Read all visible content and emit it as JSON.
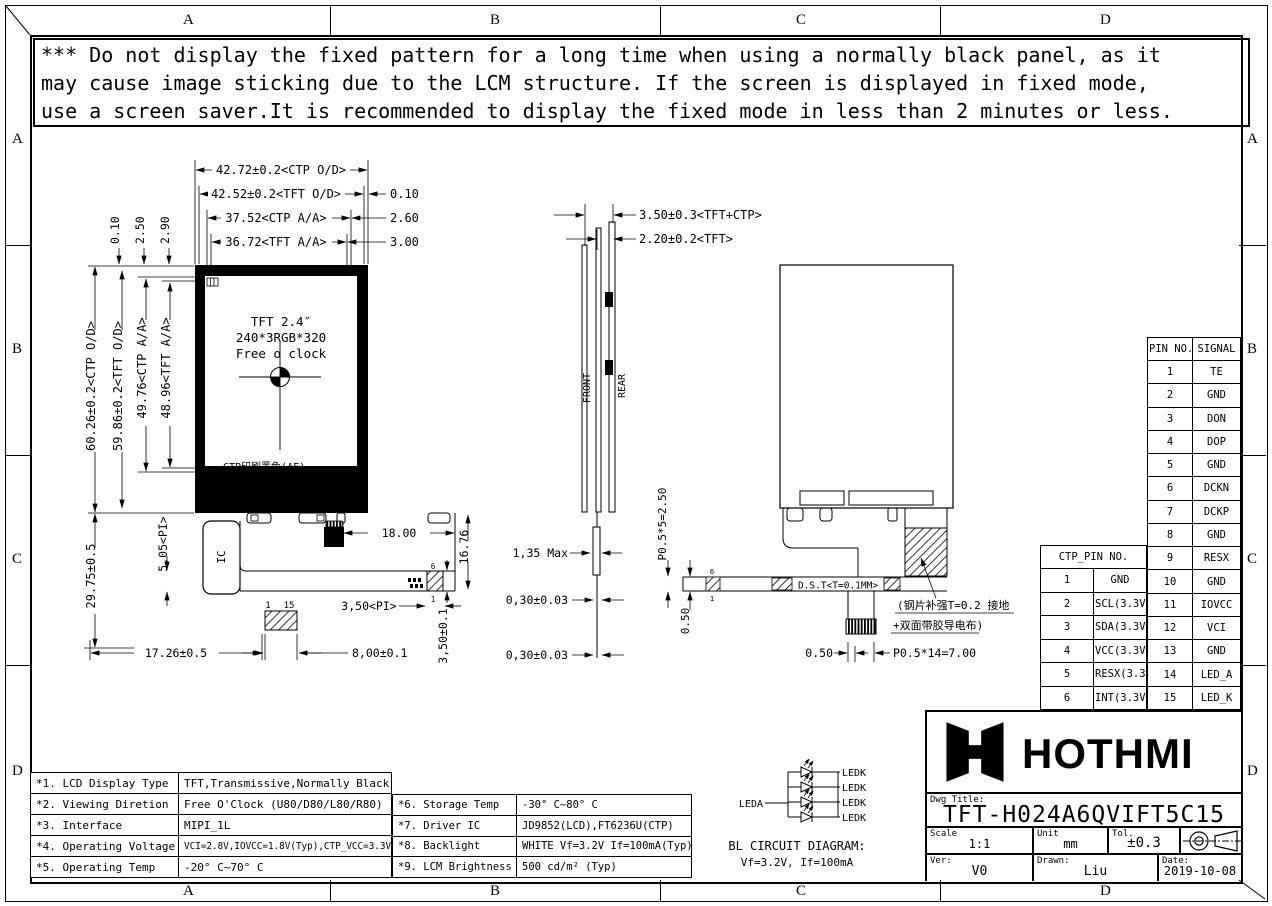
{
  "frame": {
    "zones": [
      "A",
      "B",
      "C",
      "D"
    ]
  },
  "warning": {
    "lines": [
      "*** Do not display the fixed pattern for a long time when using a normally black panel, as it",
      " may cause image sticking due to the LCM structure. If the screen is displayed in fixed mode,",
      " use a screen saver.It is recommended to display the fixed mode in less than 2 minutes or less."
    ]
  },
  "front_view": {
    "screen": {
      "line1": "TFT 2.4″",
      "line2": "240*3RGB*320",
      "line3": "Free o clock"
    },
    "ctp_print_note": "CTP印刷黑色(AF)",
    "ic_label": "IC",
    "pin_first": "1",
    "pin_last": "15",
    "tail_pin_top": "6",
    "tail_pin_bottom": "1",
    "dims": {
      "ctp_od_w": "42.72±0.2<CTP O/D>",
      "tft_od_w": "42.52±0.2<TFT O/D>",
      "offset_010": "0.10",
      "ctp_aa_w": "37.52<CTP A/A>",
      "offset_260": "2.60",
      "tft_aa_w": "36.72<TFT A/A>",
      "offset_300": "3.00",
      "top_010": "0.10",
      "top_250": "2.50",
      "top_290": "2.90",
      "ctp_od_h": "60.26±0.2<CTP O/D>",
      "tft_od_h": "59.86±0.2<TFT O/D>",
      "ctp_aa_h": "49.76<CTP A/A>",
      "tft_aa_h": "48.96<TFT A/A>",
      "left_2975": "29.75±0.5",
      "pi_505": "5,05<PI>",
      "bottom_1726": "17.26±0.5",
      "d1800": "18.00",
      "d1676": "16.76",
      "pi_350": "3,50<PI>",
      "d800": "8,00±0.1",
      "d350": "3,50±0.1"
    }
  },
  "side_view": {
    "front_label": "FRONT",
    "rear_label": "REAR",
    "tail_pin_top": "6",
    "tail_pin_bottom": "1",
    "dims": {
      "total": "3.50±0.3<TFT+CTP>",
      "tft": "2.20±0.2<TFT>",
      "max135": "1,35 Max",
      "d030a": "0,30±0.03",
      "d030b": "0,30±0.03",
      "pitch5": "P0.5*5=2.50",
      "d050": "0.50"
    }
  },
  "rear_view": {
    "dst_note": "D.S.T<T=0.1MM>",
    "stiffener_note_line1": "(钢片补强T=0.2 接地",
    "stiffener_note_line2": "+双面带胶导电布)",
    "dims": {
      "d050": "0.50",
      "pitch14": "P0.5*14=7.00"
    }
  },
  "signal_table": {
    "headers": [
      "PIN NO.",
      "SIGNAL"
    ],
    "rows": [
      [
        "1",
        "TE"
      ],
      [
        "2",
        "GND"
      ],
      [
        "3",
        "DON"
      ],
      [
        "4",
        "DOP"
      ],
      [
        "5",
        "GND"
      ],
      [
        "6",
        "DCKN"
      ],
      [
        "7",
        "DCKP"
      ],
      [
        "8",
        "GND"
      ],
      [
        "9",
        "RESX"
      ],
      [
        "10",
        "GND"
      ],
      [
        "11",
        "IOVCC"
      ],
      [
        "12",
        "VCI"
      ],
      [
        "13",
        "GND"
      ],
      [
        "14",
        "LED_A"
      ],
      [
        "15",
        "LED_K"
      ]
    ]
  },
  "ctp_table": {
    "header": "CTP_PIN NO.",
    "rows": [
      [
        "1",
        "GND"
      ],
      [
        "2",
        "SCL(3.3V)"
      ],
      [
        "3",
        "SDA(3.3V)"
      ],
      [
        "4",
        "VCC(3.3V)"
      ],
      [
        "5",
        "RESX(3.3V)"
      ],
      [
        "6",
        "INT(3.3V)"
      ]
    ]
  },
  "spec_table_left": {
    "rows": [
      [
        "*1. LCD Display Type",
        "TFT,Transmissive,Normally Black"
      ],
      [
        "*2. Viewing Diretion",
        "Free O'Clock (U80/D80/L80/R80)"
      ],
      [
        "*3. Interface",
        "MIPI_1L"
      ],
      [
        "*4. Operating Voltage",
        "VCI=2.8V,IOVCC=1.8V(Typ),CTP_VCC=3.3V"
      ],
      [
        "*5. Operating Temp",
        "-20° C~70° C"
      ]
    ]
  },
  "spec_table_right": {
    "rows": [
      [
        "*6. Storage Temp",
        "-30° C~80° C"
      ],
      [
        "*7. Driver IC",
        "JD9852(LCD),FT6236U(CTP)"
      ],
      [
        "*8. Backlight",
        "WHITE Vf=3.2V If=100mA(Typ)"
      ],
      [
        "*9. LCM Brightness",
        "500 cd/m² (Typ)"
      ]
    ]
  },
  "bl_circuit": {
    "leda": "LEDA",
    "ledk": [
      "LEDK",
      "LEDK",
      "LEDK",
      "LEDK"
    ],
    "title": "BL CIRCUIT DIAGRAM:",
    "subtitle": "Vf=3.2V, If=100mA"
  },
  "title_block": {
    "brand": "HOTHMI",
    "dwg_title_label": "Dwg Title:",
    "dwg_title": "TFT-H024A6QVIFT5C15",
    "scale_label": "Scale",
    "scale": "1:1",
    "unit_label": "Unit",
    "unit": "mm",
    "tol_label": "Tol.",
    "tol": "±0.3",
    "ver_label": "Ver:",
    "ver": "V0",
    "drawn_label": "Drawn:",
    "drawn": "Liu",
    "date_label": "Date:",
    "date": "2019-10-08"
  }
}
